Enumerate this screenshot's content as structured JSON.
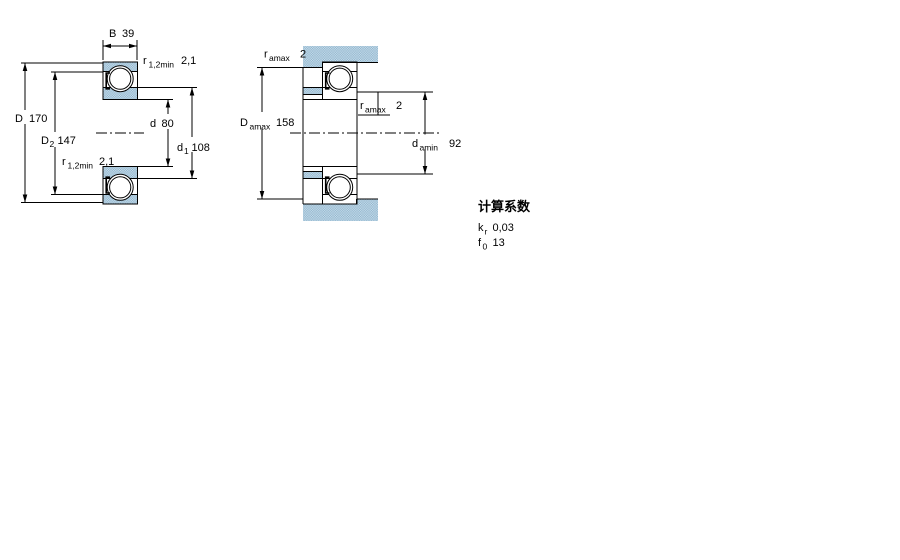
{
  "drawing": {
    "left_view": {
      "B": {
        "symbol": "B",
        "value": "39"
      },
      "r_top": {
        "symbol": "r",
        "sub": "1,2min",
        "value": "2,1"
      },
      "D": {
        "symbol": "D",
        "value": "170"
      },
      "D2": {
        "symbol": "D",
        "sub": "2",
        "value": "147"
      },
      "r_bottom": {
        "symbol": "r",
        "sub": "1,2min",
        "value": "2,1"
      },
      "d": {
        "symbol": "d",
        "value": "80"
      },
      "d1": {
        "symbol": "d",
        "sub": "1",
        "value": "108"
      }
    },
    "right_view": {
      "ra_top": {
        "symbol": "r",
        "sub": "amax",
        "value": "2"
      },
      "Da": {
        "symbol": "D",
        "sub": "amax",
        "value": "158"
      },
      "ra_mid": {
        "symbol": "r",
        "sub": "amax",
        "value": "2"
      },
      "da": {
        "symbol": "d",
        "sub": "amin",
        "value": "92"
      }
    },
    "calculation_factors": {
      "heading": "计算系数",
      "kr": {
        "symbol": "k",
        "sub": "r",
        "value": "0,03"
      },
      "f0": {
        "symbol": "f",
        "sub": "0",
        "value": "13"
      }
    },
    "colors": {
      "hatch_light": "#c9dde9",
      "hatch_dark": "#8fb5cf",
      "line": "#000000",
      "background": "#ffffff"
    }
  }
}
